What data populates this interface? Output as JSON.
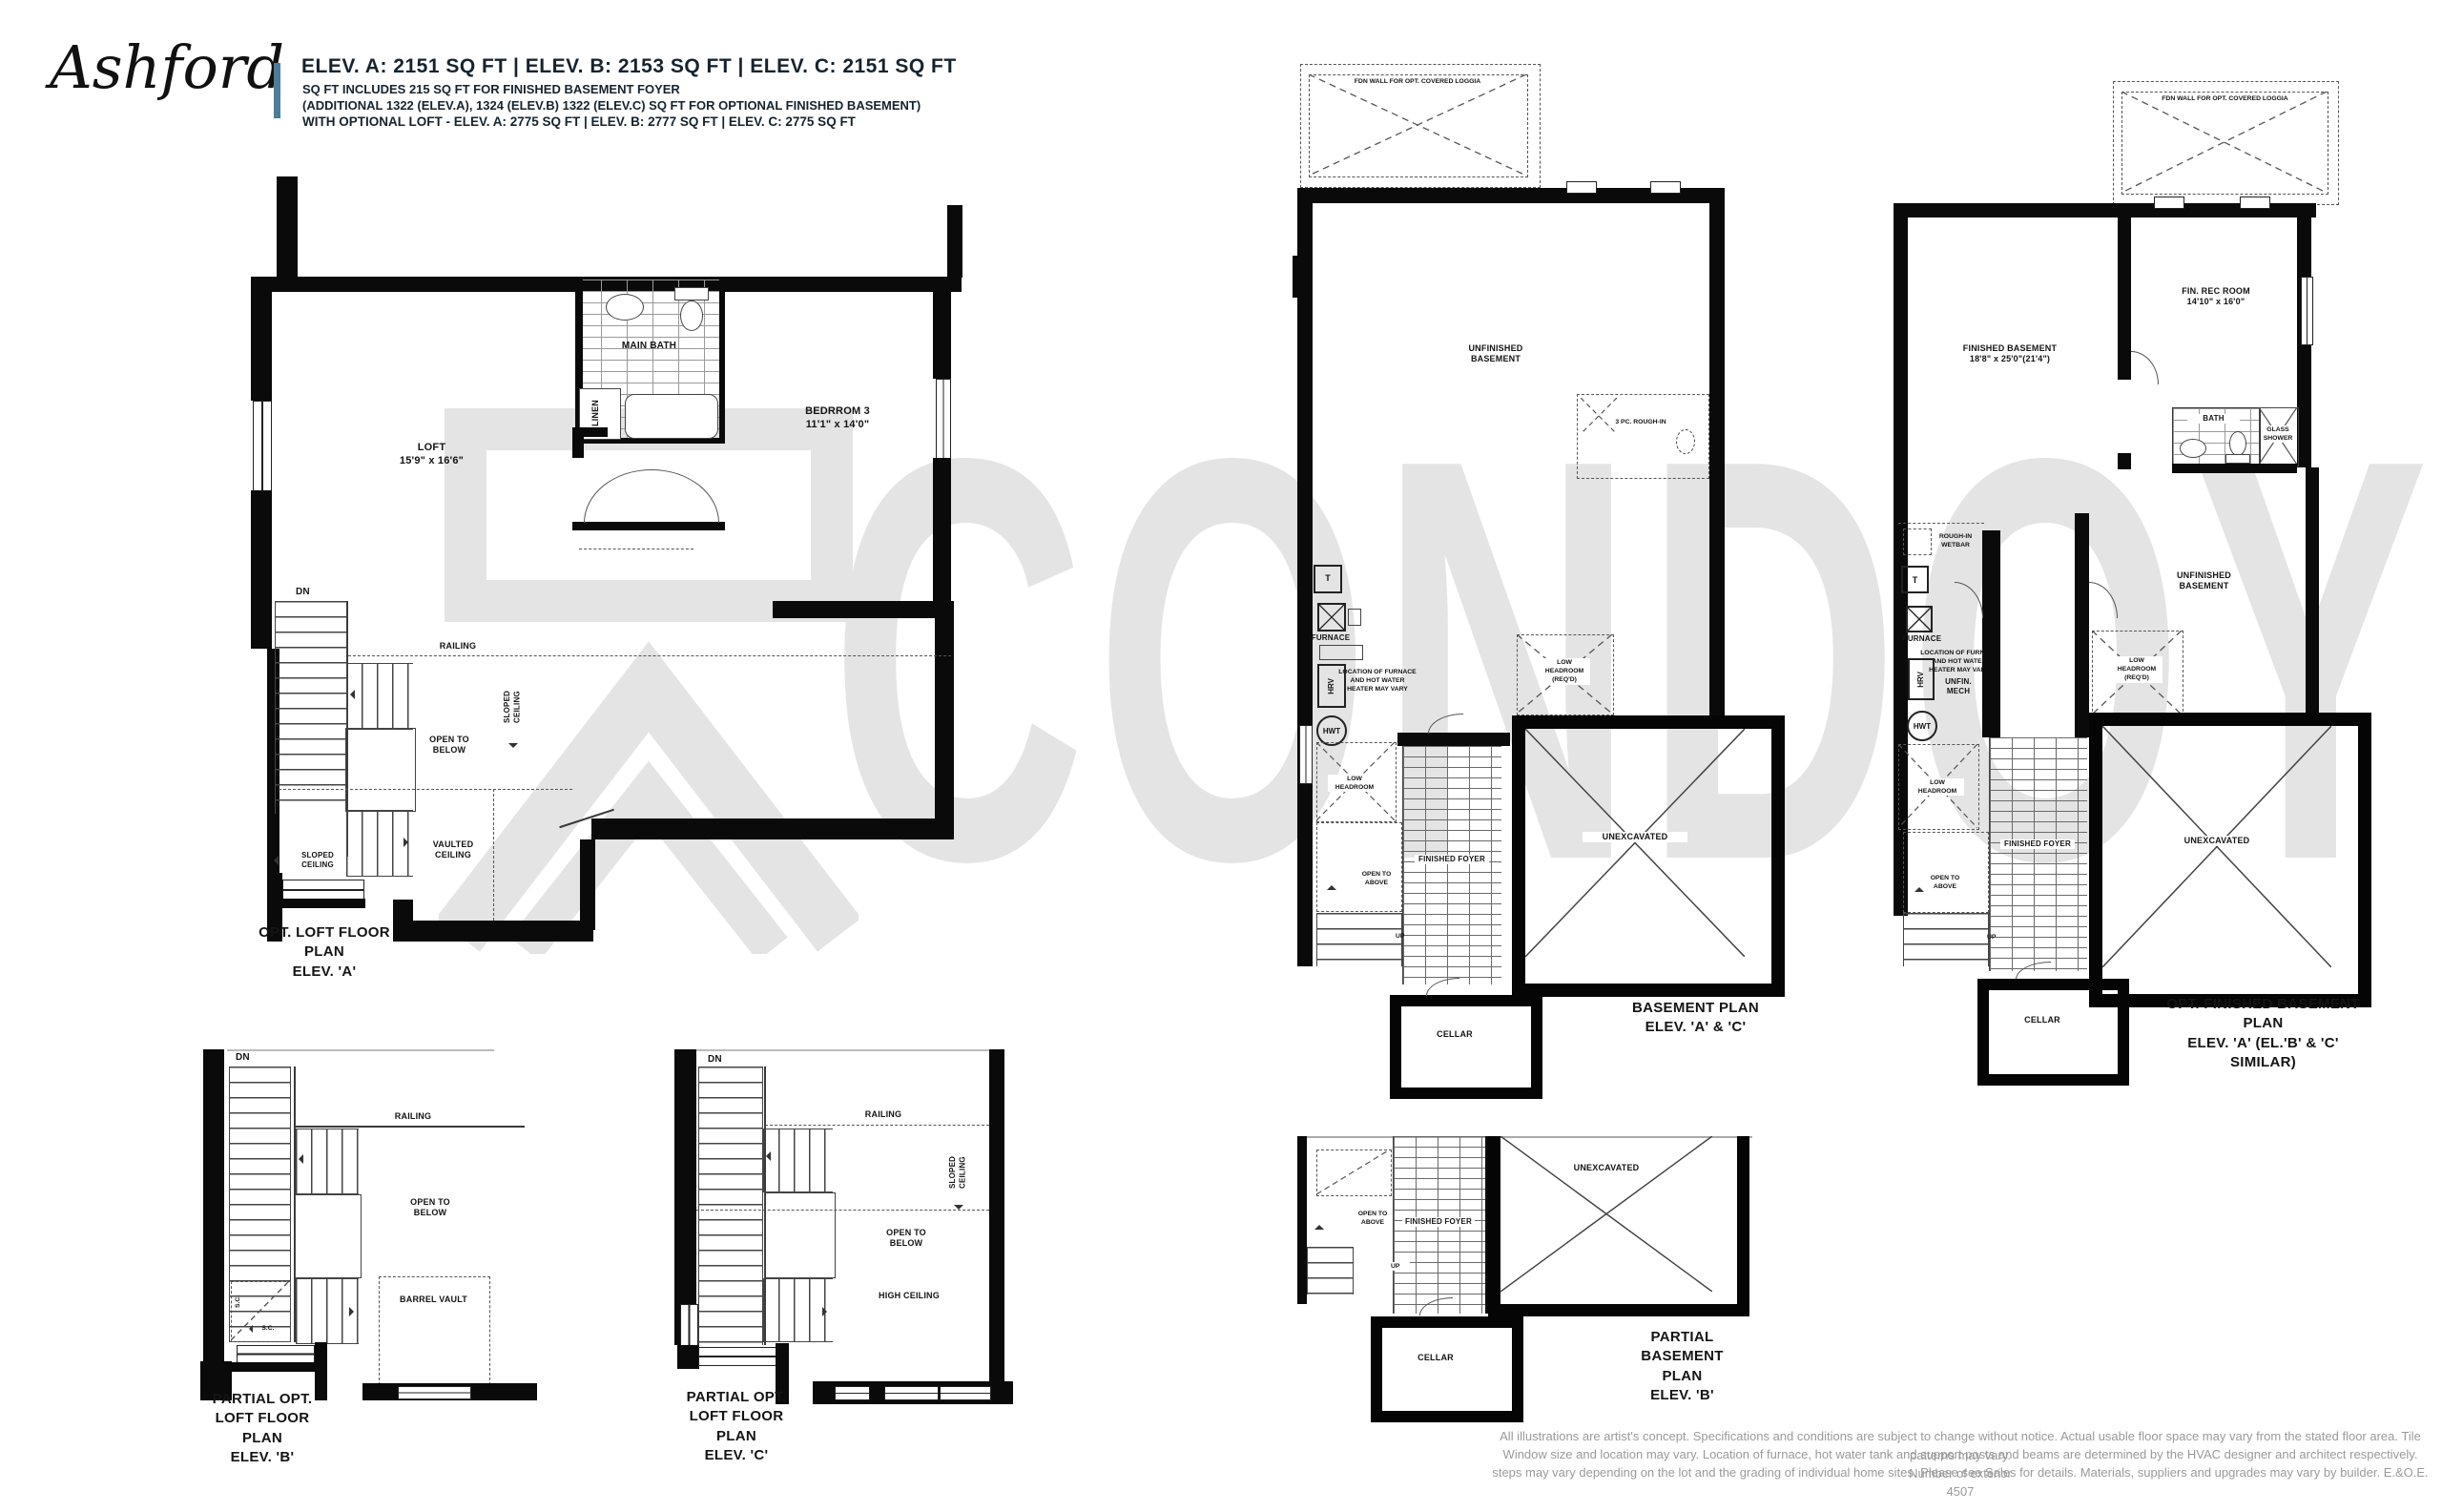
{
  "header": {
    "logo_text": "Ashford",
    "accent_color": "#4d7d9b",
    "line1": "ELEV. A: 2151 SQ FT  |  ELEV. B: 2153 SQ FT  |  ELEV. C: 2151 SQ FT",
    "line2": "SQ FT INCLUDES 215 SQ FT FOR FINISHED BASEMENT FOYER",
    "line3": "(ADDITIONAL 1322 (ELEV.A), 1324 (ELEV.B) 1322 (ELEV.C) SQ FT FOR OPTIONAL FINISHED BASEMENT)",
    "line4": "WITH OPTIONAL LOFT - ELEV. A: 2775 SQ FT  |  ELEV. B: 2777 SQ FT  |  ELEV. C: 2775 SQ FT"
  },
  "watermark": {
    "text": "CONDOY",
    "color": "#e4e4e4"
  },
  "plans": {
    "loft_a": {
      "title_line1": "OPT. LOFT FLOOR PLAN",
      "title_line2": "ELEV. 'A'",
      "labels": {
        "main_bath": "MAIN BATH",
        "linen": "LINEN",
        "bedroom3": "BEDRROM 3",
        "bedroom3_dims": "11'1\" x 14'0\"",
        "loft": "LOFT",
        "loft_dims": "15'9\" x 16'6\"",
        "dn": "DN",
        "railing": "RAILING",
        "open_to_below": "OPEN TO BELOW",
        "sloped_ceiling_v": "SLOPED CEILING",
        "vaulted_ceiling": "VAULTED CEILING",
        "sloped_ceiling_h": "SLOPED CEILING"
      }
    },
    "loft_b": {
      "title_line1": "PARTIAL OPT.",
      "title_line2": "LOFT FLOOR PLAN",
      "title_line3": "ELEV. 'B'",
      "labels": {
        "dn": "DN",
        "railing": "RAILING",
        "open_to_below": "OPEN TO BELOW",
        "barrel_vault": "BARREL VAULT",
        "sc_vertical": "S.C.",
        "sc_horizontal": "S.C."
      }
    },
    "loft_c": {
      "title_line1": "PARTIAL OPT.",
      "title_line2": "LOFT FLOOR PLAN",
      "title_line3": "ELEV. 'C'",
      "labels": {
        "dn": "DN",
        "railing": "RAILING",
        "sloped_ceiling": "SLOPED CEILING",
        "open_to_below": "OPEN TO BELOW",
        "high_ceiling": "HIGH CEILING"
      }
    },
    "basement_ac": {
      "title_line1": "BASEMENT PLAN",
      "title_line2": "ELEV. 'A' & 'C'",
      "labels": {
        "loggia": "FDN WALL FOR OPT. COVERED LOGGIA",
        "unfinished_basement": "UNFINISHED BASEMENT",
        "rough_in": "3 PC. ROUGH-IN",
        "thermostat": "T",
        "furnace": "FURNACE",
        "furnace_note": "LOCATION OF FURNACE AND HOT WATER HEATER MAY VARY",
        "hrv": "HRV",
        "hwt": "HWT",
        "low_headroom_reqd": "LOW HEADROOM (REQ'D)",
        "low_headroom": "LOW HEADROOM",
        "open_to_above": "OPEN TO ABOVE",
        "up": "UP",
        "finished_foyer": "FINISHED FOYER",
        "unexcavated": "UNEXCAVATED",
        "cellar": "CELLAR"
      }
    },
    "basement_opt": {
      "title_line1": "OPT. FINISHED BASEMENT PLAN",
      "title_line2": "ELEV. 'A' (EL.'B' & 'C' SIMILAR)",
      "labels": {
        "loggia": "FDN WALL FOR OPT. COVERED LOGGIA",
        "fin_rec_room": "FIN. REC ROOM",
        "fin_rec_room_dims": "14'10\" x 16'0\"",
        "finished_basement": "FINISHED BASEMENT",
        "finished_basement_dims": "18'8\" x 25'0\"(21'4\")",
        "bath": "BATH",
        "glass_shower": "GLASS SHOWER",
        "rough_in_wetbar": "ROUGH-IN WETBAR",
        "thermostat": "T",
        "furnace": "FURNACE",
        "furnace_note": "LOCATION OF FURNACE AND HOT WATER HEATER MAY VARY",
        "hrv": "HRV",
        "unfin_mech": "UNFIN. MECH",
        "hwt": "HWT",
        "low_headroom": "LOW HEADROOM",
        "unfinished_basement": "UNFINISHED BASEMENT",
        "low_headroom_reqd": "LOW HEADROOM (REQ'D)",
        "open_to_above": "OPEN TO ABOVE",
        "up": "UP",
        "finished_foyer": "FINISHED FOYER",
        "unexcavated": "UNEXCAVATED",
        "cellar": "CELLAR"
      }
    },
    "basement_b": {
      "title_line1": "PARTIAL",
      "title_line2": "BASEMENT PLAN",
      "title_line3": "ELEV. 'B'",
      "labels": {
        "open_to_above": "OPEN TO ABOVE",
        "up": "UP",
        "finished_foyer": "FINISHED FOYER",
        "unexcavated": "UNEXCAVATED",
        "cellar": "CELLAR"
      }
    }
  },
  "disclaimer": {
    "lines": [
      "All illustrations are artist's concept. Specifications and conditions are subject to change without notice. Actual usable floor space may vary from the stated floor area. Tile patterns may vary.",
      "Window size and location may vary. Location of furnace, hot water tank and support posts and beams are determined by the HVAC designer and architect respectively. Number of exterior",
      "steps may vary depending on the lot and the grading of individual home sites. Please see Sales for details. Materials, suppliers and upgrades may vary by builder. E.&O.E. 4507"
    ]
  }
}
